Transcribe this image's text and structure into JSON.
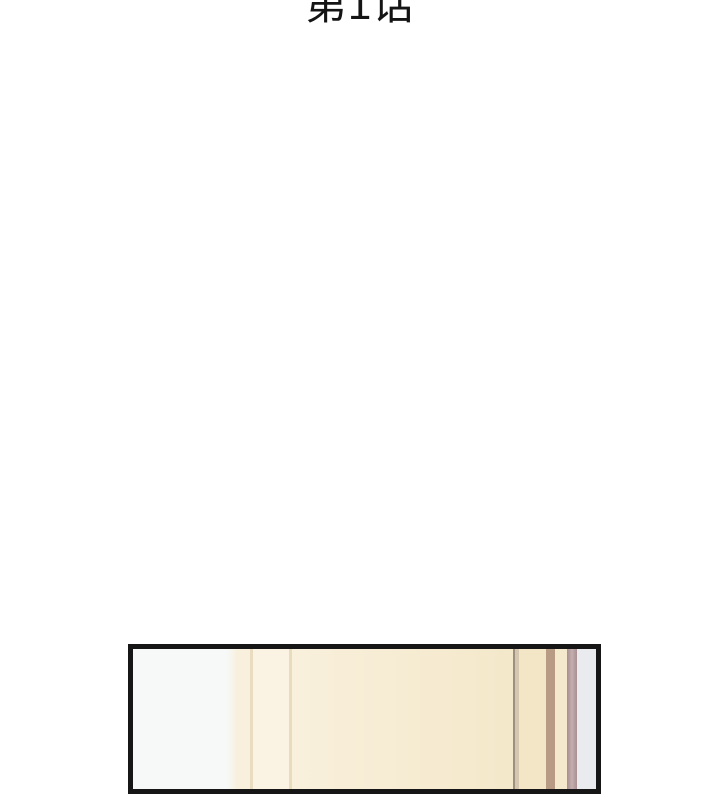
{
  "page": {
    "background_color": "#ffffff",
    "kind": "webtoon chapter page"
  },
  "chapter_title": {
    "text": "第1话",
    "color": "#141414"
  },
  "panel": {
    "border_color": "#161616",
    "border_width_px": 5,
    "description": "top sliver of first comic panel: pale wall at left, beige door/wall with vertical trim seams",
    "stripes": [
      {
        "name": "white-wall",
        "width": 94,
        "color": "#f6f9f8"
      },
      {
        "name": "wall-transition",
        "width": 10,
        "stops": [
          "#f6f9f8",
          "#f8f0dd"
        ]
      },
      {
        "name": "cream-a",
        "width": 13,
        "color": "#f8f0dd"
      },
      {
        "name": "seam-line-a",
        "width": 3,
        "color": "#e9dcc0"
      },
      {
        "name": "cream-b",
        "width": 36,
        "color": "#faf2e2"
      },
      {
        "name": "seam-line-b",
        "width": 3,
        "color": "#e9dcbe"
      },
      {
        "name": "door-main",
        "width": 221,
        "stops": [
          "#f9f0dc",
          "#f4e8ca"
        ]
      },
      {
        "name": "dark-seam",
        "width": 2,
        "color": "#9e9080"
      },
      {
        "name": "seam-highlight",
        "width": 4,
        "color": "#d5c7af"
      },
      {
        "name": "cream-c",
        "width": 27,
        "color": "#f2e6c6"
      },
      {
        "name": "tan-trim",
        "width": 9,
        "color": "#b89b84"
      },
      {
        "name": "cream-d",
        "width": 12,
        "color": "#f4e9cd"
      },
      {
        "name": "mauve-trim",
        "width": 10,
        "stops": [
          "#a98f91",
          "#c4aeae",
          "#a98f91"
        ]
      },
      {
        "name": "gray-edge",
        "width": 19,
        "color": "#e9ebee"
      }
    ]
  }
}
